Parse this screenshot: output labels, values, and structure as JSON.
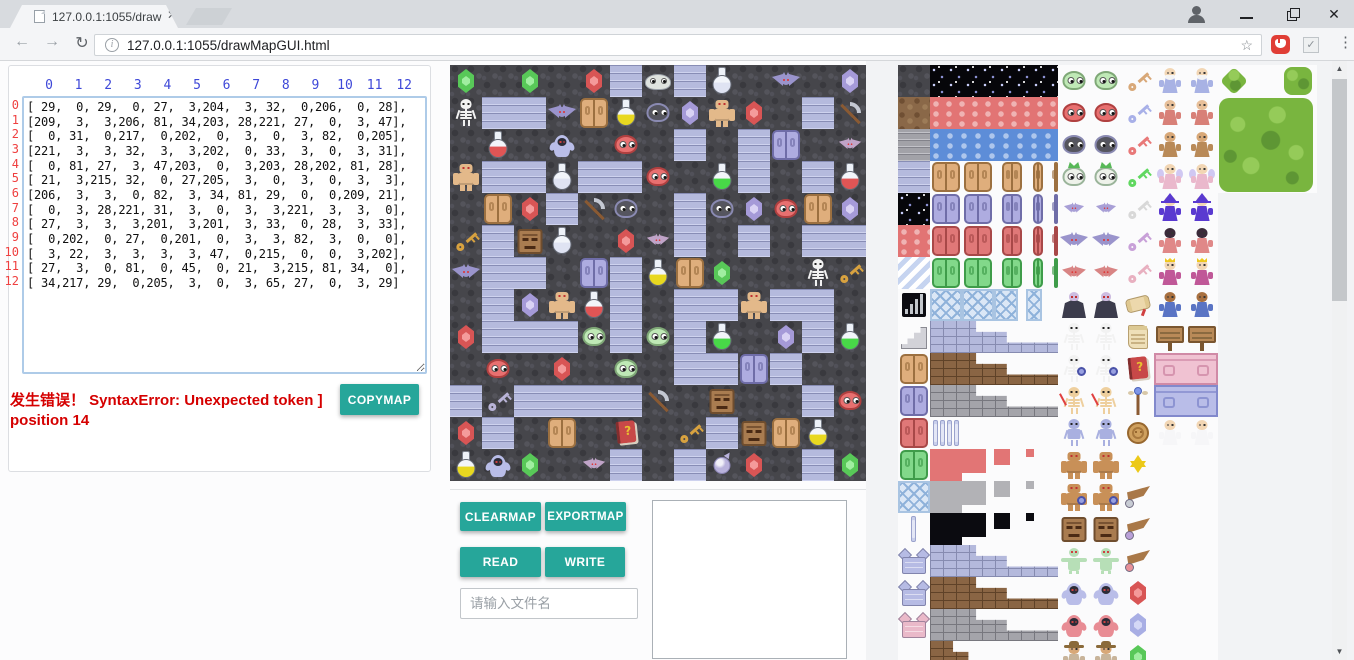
{
  "browser": {
    "tab_title": "127.0.0.1:1055/drawMa",
    "url": "127.0.0.1:1055/drawMapGUI.html",
    "icons": [
      "document-favicon",
      "tab-close",
      "profile",
      "minimize",
      "restore",
      "close",
      "back-arrow",
      "forward-arrow",
      "refresh",
      "info",
      "bookmark-star",
      "hand-extension",
      "check-extension",
      "menu-dots"
    ]
  },
  "matrix_panel": {
    "col_headers": [
      "0",
      "1",
      "2",
      "3",
      "4",
      "5",
      "6",
      "7",
      "8",
      "9",
      "10",
      "11",
      "12"
    ],
    "row_headers": [
      "0",
      "1",
      "2",
      "3",
      "4",
      "5",
      "6",
      "7",
      "8",
      "9",
      "10",
      "11",
      "12"
    ],
    "error_line1": "发生错误！ SyntaxError: Unexpected token ]",
    "error_line2": "position 14",
    "copymap_label": "COPYMAP"
  },
  "map": {
    "tile_size": 32,
    "grid": [
      [
        29,
        0,
        29,
        0,
        27,
        3,
        204,
        3,
        32,
        0,
        206,
        0,
        28
      ],
      [
        209,
        3,
        3,
        206,
        81,
        34,
        203,
        28,
        221,
        27,
        0,
        3,
        47
      ],
      [
        0,
        31,
        0,
        217,
        0,
        202,
        0,
        3,
        0,
        3,
        82,
        0,
        205
      ],
      [
        221,
        3,
        3,
        32,
        3,
        3,
        202,
        0,
        33,
        3,
        0,
        3,
        31
      ],
      [
        0,
        81,
        27,
        3,
        47,
        203,
        0,
        3,
        203,
        28,
        202,
        81,
        28
      ],
      [
        21,
        3,
        215,
        32,
        0,
        27,
        205,
        3,
        0,
        3,
        0,
        3,
        3
      ],
      [
        206,
        3,
        3,
        0,
        82,
        3,
        34,
        81,
        29,
        0,
        0,
        209,
        21
      ],
      [
        0,
        3,
        28,
        221,
        31,
        3,
        0,
        3,
        3,
        221,
        3,
        3,
        0
      ],
      [
        27,
        3,
        3,
        3,
        201,
        3,
        201,
        3,
        33,
        0,
        28,
        3,
        33
      ],
      [
        0,
        202,
        0,
        27,
        0,
        201,
        0,
        3,
        3,
        82,
        3,
        0,
        0
      ],
      [
        3,
        22,
        3,
        3,
        3,
        3,
        47,
        0,
        215,
        0,
        0,
        3,
        202
      ],
      [
        27,
        3,
        0,
        81,
        0,
        45,
        0,
        21,
        3,
        215,
        81,
        34,
        0
      ],
      [
        34,
        217,
        29,
        0,
        205,
        3,
        0,
        3,
        65,
        27,
        0,
        3,
        29
      ]
    ],
    "legend": {
      "0": "tex:rock",
      "3": "tex:brick",
      "21": "key:#d8a23f",
      "22": "key:#b9b4d8",
      "27": "gem:#d85555:#f49a9a",
      "28": "gem:#a59ad8:#d9d2f4",
      "29": "gem:#58c858:#a0eea0",
      "31": "flask:#e05555",
      "32": "flask:#dfe3f2",
      "33": "flask:#48d848",
      "34": "flask:#e8d820",
      "45": "book:#c84848",
      "47": "pick",
      "65": "orb:#b9b2dc",
      "81": "door:#dfae7c:#9c7040",
      "82": "door:#aeace0:#6f6da8",
      "201": "blob:#bfe9b6:#7fa877",
      "202": "blob:#e87070:#b04040",
      "203": "blob:#55555f:#8a8ab2",
      "204": "slimeflat:#dfe3df",
      "205": "bat:#c0a4c8:0.8",
      "206": "bat:#9a94cc:1",
      "209": "skel:#f2f2f2",
      "215": "facek:#a97c50",
      "217": "ghostk:#b9bde8",
      "221": "golem:#e3b98a"
    },
    "legend_names": {
      "0": "dark-rock-floor",
      "3": "brick-wall",
      "21": "gold-key",
      "22": "silver-key",
      "27": "red-gem",
      "28": "purple-gem",
      "29": "green-gem",
      "31": "red-potion",
      "32": "silver-potion",
      "33": "green-potion",
      "34": "yellow-potion",
      "45": "spell-book",
      "47": "pickaxe",
      "65": "purple-orb",
      "81": "wooden-door",
      "82": "purple-door",
      "201": "green-slime",
      "202": "red-slime",
      "203": "dark-slime",
      "204": "white-slime",
      "205": "red-bat",
      "206": "purple-bat",
      "209": "skeleton",
      "215": "stone-face",
      "217": "ghost",
      "221": "golem"
    }
  },
  "controls": {
    "clearmap": "CLEARMAP",
    "exportmap": "EXPORTMAP",
    "read": "READ",
    "write": "WRITE",
    "filename_placeholder": "请输入文件名"
  },
  "tileset": {
    "underlays": [
      [
        0,
        0,
        5,
        19
      ],
      [
        5,
        0,
        5,
        19
      ],
      [
        10,
        0,
        3.1,
        4
      ]
    ],
    "cells": [
      [
        0,
        0,
        1,
        1,
        "tex:rock"
      ],
      [
        1,
        0,
        4,
        1,
        "tex:starry"
      ],
      [
        5,
        0,
        1,
        1,
        "blob:#bfe9b6:#7fa877"
      ],
      [
        6,
        0,
        1,
        1,
        "blob:#bfe9b6:#7fa877"
      ],
      [
        7,
        0,
        1,
        1,
        "key:#d8a878"
      ],
      [
        8,
        0,
        1,
        1,
        "person:#a8b2e4:#f2d6b4:beard"
      ],
      [
        9,
        0,
        1,
        1,
        "person:#a8b2e4:#f2d6b4:beard"
      ],
      [
        10,
        0,
        1,
        1,
        "bushd"
      ],
      [
        12,
        0,
        1,
        1,
        "bush"
      ],
      [
        0,
        1,
        1,
        1,
        "tex:dirt"
      ],
      [
        1,
        1,
        4,
        1,
        "tex:redwave"
      ],
      [
        5,
        1,
        1,
        1,
        "blob:#e87070:#b04040"
      ],
      [
        6,
        1,
        1,
        1,
        "blob:#e87070:#b04040"
      ],
      [
        7,
        1,
        1,
        1,
        "key:#a8b0e8"
      ],
      [
        8,
        1,
        1,
        1,
        "person:#d88078:#e8c09a"
      ],
      [
        9,
        1,
        1,
        1,
        "person:#d88078:#e8c09a"
      ],
      [
        10,
        1,
        3,
        3,
        "tree"
      ],
      [
        0,
        2,
        1,
        1,
        "tex:stone"
      ],
      [
        1,
        2,
        4,
        1,
        "tex:water"
      ],
      [
        5,
        2,
        1,
        1,
        "blob:#55555f:#8a8ab2"
      ],
      [
        6,
        2,
        1,
        1,
        "blob:#55555f:#8a8ab2"
      ],
      [
        7,
        2,
        1,
        1,
        "key:#e87878"
      ],
      [
        8,
        2,
        1,
        1,
        "person:#b98a58:#d8a878"
      ],
      [
        9,
        2,
        1,
        1,
        "person:#b98a58:#d8a878"
      ],
      [
        0,
        3,
        1,
        1,
        "tex:brick"
      ],
      [
        1,
        3,
        1,
        1,
        "door:#dfae7c:#9c7040"
      ],
      [
        2,
        3,
        1,
        1,
        "door:#dfae7c:#9c7040"
      ],
      [
        3.2,
        3,
        0.75,
        1,
        "door:#dfae7c:#9c7040"
      ],
      [
        4.15,
        3,
        0.45,
        1,
        "door:#dfae7c:#9c7040"
      ],
      [
        4.8,
        3,
        0.2,
        1,
        "door:#dfae7c:#9c7040"
      ],
      [
        5,
        3,
        1,
        1,
        "crownblob"
      ],
      [
        6,
        3,
        1,
        1,
        "crownblob"
      ],
      [
        7,
        3,
        1,
        1,
        "key:#60d860"
      ],
      [
        8,
        3,
        1,
        1,
        "person:#eab8cc:#f2d6b4:wings"
      ],
      [
        9,
        3,
        1,
        1,
        "person:#eab8cc:#f2d6b4:wings"
      ],
      [
        0,
        4,
        1,
        1,
        "tex:starry"
      ],
      [
        1,
        4,
        1,
        1,
        "door:#aeace0:#6f6da8"
      ],
      [
        2,
        4,
        1,
        1,
        "door:#aeace0:#6f6da8"
      ],
      [
        3.2,
        4,
        0.75,
        1,
        "door:#aeace0:#6f6da8"
      ],
      [
        4.15,
        4,
        0.45,
        1,
        "door:#aeace0:#6f6da8"
      ],
      [
        4.8,
        4,
        0.2,
        1,
        "door:#aeace0:#6f6da8"
      ],
      [
        5,
        4,
        1,
        1,
        "bat:#a89fd6:0.72"
      ],
      [
        6,
        4,
        1,
        1,
        "bat:#a89fd6:0.72"
      ],
      [
        7,
        4,
        1,
        1,
        "key:#d8d8d8"
      ],
      [
        8,
        4,
        1,
        1,
        "person:#5a3ad0:#f2d6b4:hat"
      ],
      [
        9,
        4,
        1,
        1,
        "person:#5a3ad0:#f2d6b4:hat"
      ],
      [
        0,
        5,
        1,
        1,
        "tex:redwave"
      ],
      [
        1,
        5,
        1,
        1,
        "door:#e07878:#a84848"
      ],
      [
        2,
        5,
        1,
        1,
        "door:#e07878:#a84848"
      ],
      [
        3.2,
        5,
        0.75,
        1,
        "door:#e07878:#a84848"
      ],
      [
        4.15,
        5,
        0.45,
        1,
        "door:#e07878:#a84848"
      ],
      [
        4.8,
        5,
        0.2,
        1,
        "door:#e07878:#a84848"
      ],
      [
        5,
        5,
        1,
        1,
        "bat:#9a94cc:1"
      ],
      [
        6,
        5,
        1,
        1,
        "bat:#9a94cc:1"
      ],
      [
        7,
        5,
        1,
        1,
        "key:#c8a0d8"
      ],
      [
        8,
        5,
        1,
        1,
        "person:#e08888:#3a2a3a"
      ],
      [
        9,
        5,
        1,
        1,
        "person:#e08888:#3a2a3a"
      ],
      [
        0,
        6,
        1,
        1,
        "tex:stripes"
      ],
      [
        1,
        6,
        1,
        1,
        "door:#82d88a:#3f9c4a"
      ],
      [
        2,
        6,
        1,
        1,
        "door:#82d88a:#3f9c4a"
      ],
      [
        3.2,
        6,
        0.75,
        1,
        "door:#82d88a:#3f9c4a"
      ],
      [
        4.15,
        6,
        0.45,
        1,
        "door:#82d88a:#3f9c4a"
      ],
      [
        4.8,
        6,
        0.2,
        1,
        "door:#82d88a:#3f9c4a"
      ],
      [
        5,
        6,
        1,
        1,
        "bat:#d88484:0.85"
      ],
      [
        6,
        6,
        1,
        1,
        "bat:#d88484:0.85"
      ],
      [
        7,
        6,
        1,
        1,
        "key:#e8b0c0"
      ],
      [
        8,
        6,
        1,
        1,
        "person:#c05898:#f2d6b4:crown"
      ],
      [
        9,
        6,
        1,
        1,
        "person:#c05898:#f2d6b4:crown"
      ],
      [
        0,
        7,
        1,
        1,
        "stairsicon"
      ],
      [
        1,
        7,
        1,
        1,
        "latt"
      ],
      [
        2,
        7,
        1,
        1,
        "latt"
      ],
      [
        3,
        7,
        0.75,
        1,
        "latt"
      ],
      [
        4,
        7,
        0.5,
        1,
        "latt"
      ],
      [
        5,
        7,
        1,
        1,
        "vamp"
      ],
      [
        6,
        7,
        1,
        1,
        "vamp"
      ],
      [
        7,
        7,
        1,
        1,
        "scrollk"
      ],
      [
        8,
        7,
        1,
        1,
        "person:#5a74c4:#a87040"
      ],
      [
        9,
        7,
        1,
        1,
        "person:#5a74c4:#a87040"
      ],
      [
        0,
        8,
        1,
        1,
        "stairs"
      ],
      [
        1,
        8,
        4,
        1,
        "bsteps:#b4b9dc:#868bb0"
      ],
      [
        5,
        8,
        1,
        1,
        "skel:#f2f2f2"
      ],
      [
        6,
        8,
        1,
        1,
        "skel:#f2f2f2"
      ],
      [
        7,
        8,
        1,
        1,
        "parch"
      ],
      [
        8,
        8,
        1,
        1,
        "sign"
      ],
      [
        9,
        8,
        1,
        1,
        "sign"
      ],
      [
        0,
        9,
        1,
        1,
        "door:#dfae7c:#9c7040"
      ],
      [
        1,
        9,
        4,
        1,
        "bsteps:#8a6544:#5f4228"
      ],
      [
        5,
        9,
        1,
        1,
        "skel:#f2f2f2:shield"
      ],
      [
        6,
        9,
        1,
        1,
        "skel:#f2f2f2:shield"
      ],
      [
        7,
        9,
        1,
        1,
        "book:#c84848"
      ],
      [
        8,
        9,
        2,
        1,
        "wall:#f0c2d2:#d08aa6"
      ],
      [
        0,
        10,
        1,
        1,
        "door:#aeace0:#6f6da8"
      ],
      [
        1,
        10,
        4,
        1,
        "bsteps:#a4a4aa:#77777e"
      ],
      [
        5,
        10,
        1,
        1,
        "skel:#eecf9e:sword"
      ],
      [
        6,
        10,
        1,
        1,
        "skel:#eecf9e:sword"
      ],
      [
        7,
        10,
        1,
        1,
        "staff"
      ],
      [
        8,
        10,
        2,
        1,
        "wall:#b9bde8:#8289cc"
      ],
      [
        0,
        11,
        1,
        1,
        "door:#e07878:#a84848"
      ],
      [
        1,
        11,
        3,
        1,
        "pillars:4"
      ],
      [
        5,
        11,
        1,
        1,
        "skel:#a9b0e0:armor"
      ],
      [
        6,
        11,
        1,
        1,
        "skel:#a9b0e0:armor"
      ],
      [
        7,
        11,
        1,
        1,
        "medal"
      ],
      [
        8,
        11,
        1,
        1,
        "person:#f6f6f8:#f2d6b4"
      ],
      [
        9,
        11,
        1,
        1,
        "person:#f6f6f8:#f2d6b4"
      ],
      [
        0,
        12,
        1,
        1,
        "door:#82d88a:#3f9c4a"
      ],
      [
        1,
        12,
        1,
        1,
        "sq:#e27575"
      ],
      [
        2,
        12,
        0.75,
        0.75,
        "sq:#e27575"
      ],
      [
        3,
        12,
        0.5,
        0.5,
        "sq:#e27575"
      ],
      [
        4,
        12,
        0.25,
        0.25,
        "sq:#e27575"
      ],
      [
        5,
        12,
        1,
        1,
        "golem:#c89058"
      ],
      [
        6,
        12,
        1,
        1,
        "golem:#c89058"
      ],
      [
        7,
        12,
        1,
        1,
        "star"
      ],
      [
        0,
        13,
        1,
        1,
        "latt"
      ],
      [
        1,
        13,
        1,
        1,
        "sq:#b2b2b6"
      ],
      [
        2,
        13,
        0.75,
        0.75,
        "sq:#b2b2b6"
      ],
      [
        3,
        13,
        0.5,
        0.5,
        "sq:#b2b2b6"
      ],
      [
        4,
        13,
        0.25,
        0.25,
        "sq:#b2b2b6"
      ],
      [
        5,
        13,
        1,
        1,
        "golem:#c89058:shield"
      ],
      [
        6,
        13,
        1,
        1,
        "golem:#c89058:shield"
      ],
      [
        7,
        13,
        1,
        1,
        "wing:#c8ccd4"
      ],
      [
        0,
        14,
        1,
        1,
        "pillars:1"
      ],
      [
        1,
        14,
        1,
        1,
        "sq:#0b0b10"
      ],
      [
        2,
        14,
        0.75,
        0.75,
        "sq:#0b0b10"
      ],
      [
        3,
        14,
        0.5,
        0.5,
        "sq:#0b0b10"
      ],
      [
        4,
        14,
        0.25,
        0.25,
        "sq:#0b0b10"
      ],
      [
        5,
        14,
        1,
        1,
        "facek:#a97c50"
      ],
      [
        6,
        14,
        1,
        1,
        "facek:#a97c50"
      ],
      [
        7,
        14,
        1,
        1,
        "wing:#b9a0d8"
      ],
      [
        0,
        15,
        1,
        1,
        "battile:#b6bbe4"
      ],
      [
        1,
        15,
        4,
        1,
        "bsteps:#b4b9dc:#868bb0"
      ],
      [
        5,
        15,
        1,
        1,
        "mummy"
      ],
      [
        6,
        15,
        1,
        1,
        "mummy"
      ],
      [
        7,
        15,
        1,
        1,
        "wing:#e89098"
      ],
      [
        0,
        16,
        1,
        1,
        "battile:#b6bbe4"
      ],
      [
        1,
        16,
        4,
        1,
        "bsteps:#8a6544:#5f4228"
      ],
      [
        5,
        16,
        1,
        1,
        "ghostk:#b9bde8"
      ],
      [
        6,
        16,
        1,
        1,
        "ghostk:#b9bde8"
      ],
      [
        7,
        16,
        1,
        1,
        "gem:#d85555:#f49a9a"
      ],
      [
        0,
        17,
        1,
        1,
        "battile:#eab9c9"
      ],
      [
        1,
        17,
        4,
        1,
        "bsteps:#a4a4aa:#77777e"
      ],
      [
        5,
        17,
        1,
        1,
        "ghostk:#e88c94"
      ],
      [
        6,
        17,
        1,
        1,
        "ghostk:#e88c94"
      ],
      [
        7,
        17,
        1,
        1,
        "gem:#a8aee4:#d4d8f6"
      ],
      [
        1,
        18,
        2,
        1,
        "bsteps:#8a6544:#5f4228"
      ],
      [
        5,
        18,
        1,
        1,
        "person:#c8b49a:#d8a878:hatwide"
      ],
      [
        6,
        18,
        1,
        1,
        "person:#c8b49a:#d8a878:hatwide"
      ],
      [
        7,
        18,
        1,
        1,
        "gem:#58c858:#a0eea0"
      ]
    ]
  },
  "colors": {
    "teal_button": "#26a69a",
    "error_red": "#d50000",
    "header_blue": "#3e48d8",
    "header_red": "#ef4040"
  }
}
